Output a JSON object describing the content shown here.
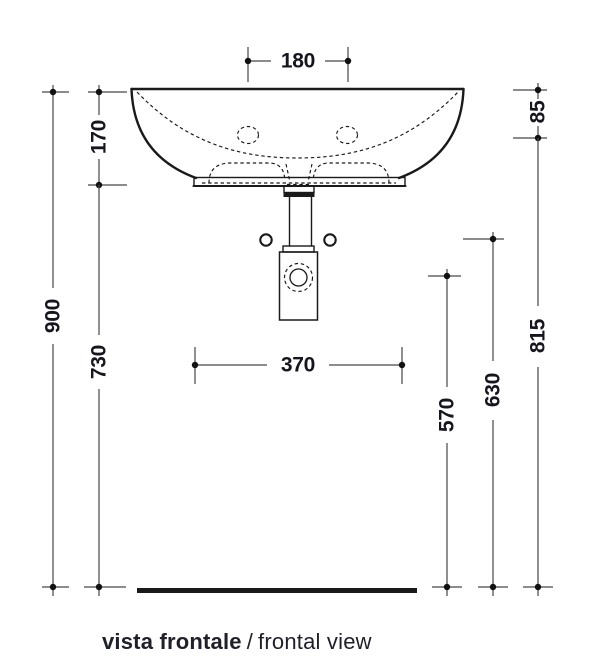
{
  "drawing": {
    "type": "technical-dimension-drawing",
    "subject": "wall-hung washbasin with bottle trap, frontal elevation"
  },
  "dimensions": {
    "top_hole_spacing": "180",
    "left_basin_height": "170",
    "left_total_height": "900",
    "left_under_basin": "730",
    "bottom_base_width": "370",
    "right_rim_offset": "85",
    "right_total": "815",
    "right_mid": "630",
    "right_inner": "570"
  },
  "caption": {
    "italian": "vista frontale",
    "separator": "/",
    "english": "frontal view"
  },
  "colors": {
    "bg": "#ffffff",
    "object_line": "#1a1a1a",
    "dim_line": "#474747",
    "dot": "#111111",
    "dim_text": "#16161f",
    "caption_text": "#20202a"
  }
}
